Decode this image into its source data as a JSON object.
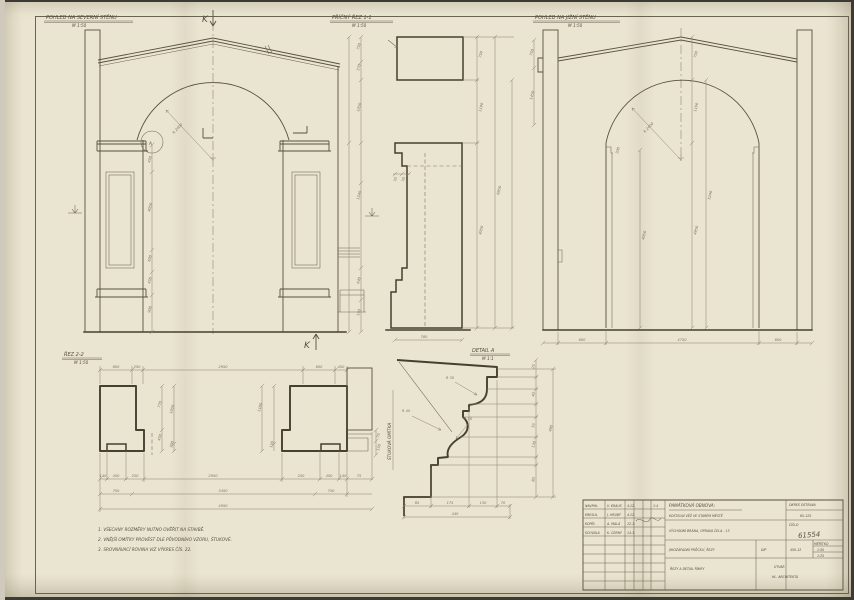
{
  "colors": {
    "paper": "#eae5d1",
    "ink": "#45402f",
    "dim_ink": "#8a8068",
    "hand_ink": "#55503e"
  },
  "sheet_markers": {
    "section_top": "K",
    "section_bottom": "K",
    "detail_ref": "A"
  },
  "views": {
    "north": {
      "title": "POHLED NA SEVERNÍ STĚNU",
      "scale": "M 1:50",
      "radius": "R 2400",
      "v_dims": [
        "450",
        "4050",
        "600",
        "450",
        "900"
      ]
    },
    "section1": {
      "title": "PŘÍČNÝ ŘEZ 1-1",
      "scale": "M 1:50",
      "left_dims": [
        "750",
        "370",
        "1050",
        "1540",
        "640",
        "150"
      ],
      "inner_dims": [
        "70",
        "70"
      ],
      "right_dims": [
        "750",
        "1190",
        "4050"
      ],
      "overall": "6850",
      "bottom": "780"
    },
    "south": {
      "title": "POHLED NA JIŽNÍ STĚNU",
      "scale": "M 1:50",
      "radius": "R 2400",
      "wall_dims": [
        "750",
        "1450"
      ],
      "jamb_dim": "4050",
      "notch_dim": "300",
      "mid_dims": [
        "750",
        "1190",
        "4950"
      ],
      "overall": "5240",
      "bottom_dims": [
        "600",
        "4750",
        "600"
      ]
    },
    "plan": {
      "title": "ŘEZ 2-2",
      "scale": "M 1:50",
      "top_dims": [
        "600",
        "250",
        "2950",
        "600",
        "450"
      ],
      "left_pier_dims": [
        "770",
        "450"
      ],
      "mid_pier_dims": [
        "1050",
        "300"
      ],
      "right_pier_dims": [
        "1180",
        "150"
      ],
      "wall_dims": [
        "75",
        "150"
      ],
      "chain1": [
        "140",
        "450",
        "250",
        "2950",
        "250",
        "450",
        "140",
        "75"
      ],
      "chain2": [
        "750",
        "3450",
        "750"
      ],
      "chain3": "4950"
    },
    "detail": {
      "title": "DETAIL A",
      "scale": "M 1:1",
      "radii": [
        "R 30",
        "R 45",
        "R 50"
      ],
      "right_dims": [
        "25",
        "40",
        "55",
        "130",
        "80"
      ],
      "right_overall": "480",
      "bottom_dims": [
        "65",
        "175",
        "130",
        "70"
      ],
      "bottom_overall": "440",
      "side_note": "ŠTUKOVÁ OMÍTKA"
    }
  },
  "notes": {
    "line1": "1. VŠECHNY ROZMĚRY NUTNO OVĚŘIT NA STAVBĚ.",
    "line2": "2. VNĚJŠÍ OMÍTKY PROVÉST DLE PŮVODNÍHO VZORU, ŠTUKOVÉ.",
    "line3": "3. SROVNÁVACÍ ROVINA VIZ VÝKRES ČÍS. 22."
  },
  "title_block": {
    "rows": [
      {
        "label": "NAVRHL",
        "name": "V. KRAUS",
        "date": "4.12."
      },
      {
        "label": "KRESLIL",
        "name": "J. HRUBÝ",
        "date": "4.12."
      },
      {
        "label": "KOPÍR.",
        "name": "A. MALÁ",
        "date": "12.1."
      },
      {
        "label": "SCHVÁLIL",
        "name": "K. ČERNÝ",
        "date": "14.1."
      }
    ],
    "format": "1:4",
    "heading": "PAMÁTKOVÁ OBNOVA:",
    "object": "KOSTELNÍ VĚŽ VE STARÉM MĚSTĚ",
    "district": "OKRES OSTRAVA",
    "code": "65-125",
    "part": "VÝCHODNÍ BRÁNA, OPRAVA ČELA - 13",
    "number_label": "ČÍSLO",
    "number": "61554",
    "content": "JIHOZÁPADNÍ PRŮČELÍ, ŘEZY",
    "stage": "DIP",
    "order": "450-12",
    "scale_label": "MĚŘÍTKO",
    "scales": [
      "1:50",
      "1:25"
    ],
    "sheet_content": "ŘEZY A DETAIL ŘÍMSY",
    "org1": "ÚTVAR",
    "org2": "HL. ARCHITEKTA"
  }
}
